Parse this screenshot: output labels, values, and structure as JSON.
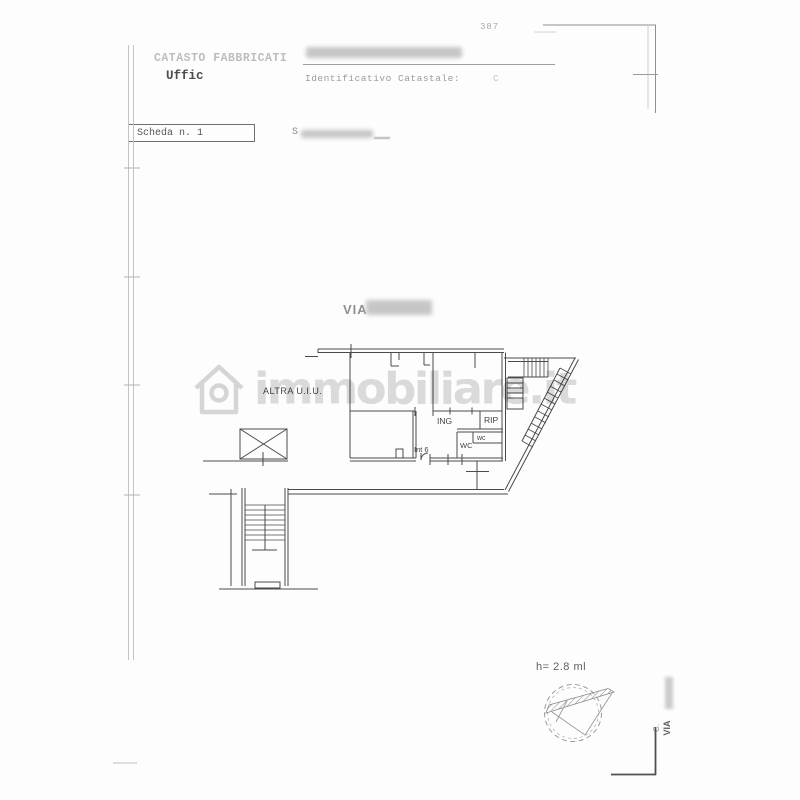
{
  "page": {
    "corner_number": "387",
    "header": {
      "registry_title": "CATASTO FABBRICATI",
      "office_line": "Uffic",
      "identifier_label": "Identificativo Catastale:",
      "identifier_suffix": "C"
    },
    "sheet_bar": {
      "sheet_label": "Scheda n. 1",
      "scale_fragment": "S"
    },
    "plan": {
      "street_prefix": "VIA",
      "other_unit_label": "ALTRA U.I.U.",
      "rooms": {
        "entrance": "ING",
        "storage": "RIP",
        "wc_small": "wc",
        "wc_main": "WC",
        "unit_number": "Int 6"
      },
      "height_note": "h= 2.8 ml"
    },
    "side_text": {
      "outer": "VIA",
      "inner": "C."
    },
    "watermark_text": "immobiliare.it",
    "colors": {
      "ink": "#4a4a4a",
      "faint_ink": "#9a9a9a",
      "redaction": "#c6c6c6",
      "watermark": "#dcdcdc"
    }
  }
}
